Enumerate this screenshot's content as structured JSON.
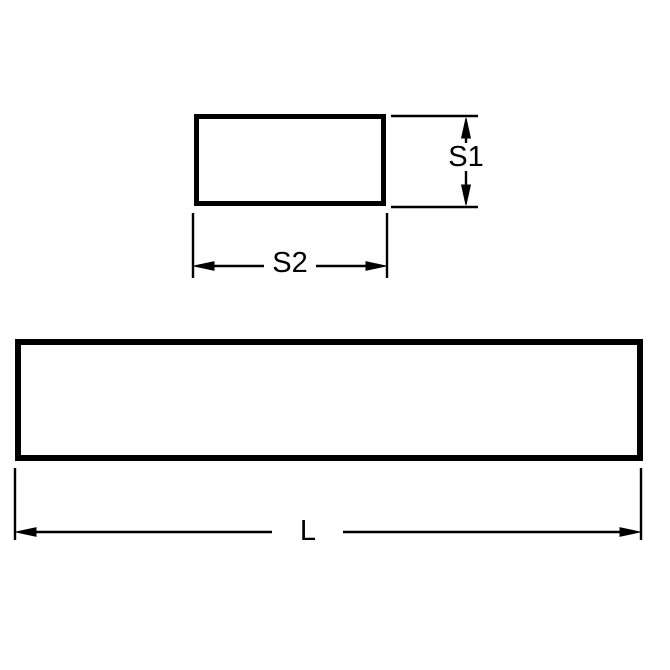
{
  "diagram": {
    "labels": {
      "height": "S1",
      "width": "S2",
      "length": "L"
    },
    "colors": {
      "line": "#000000",
      "background": "#ffffff"
    }
  }
}
